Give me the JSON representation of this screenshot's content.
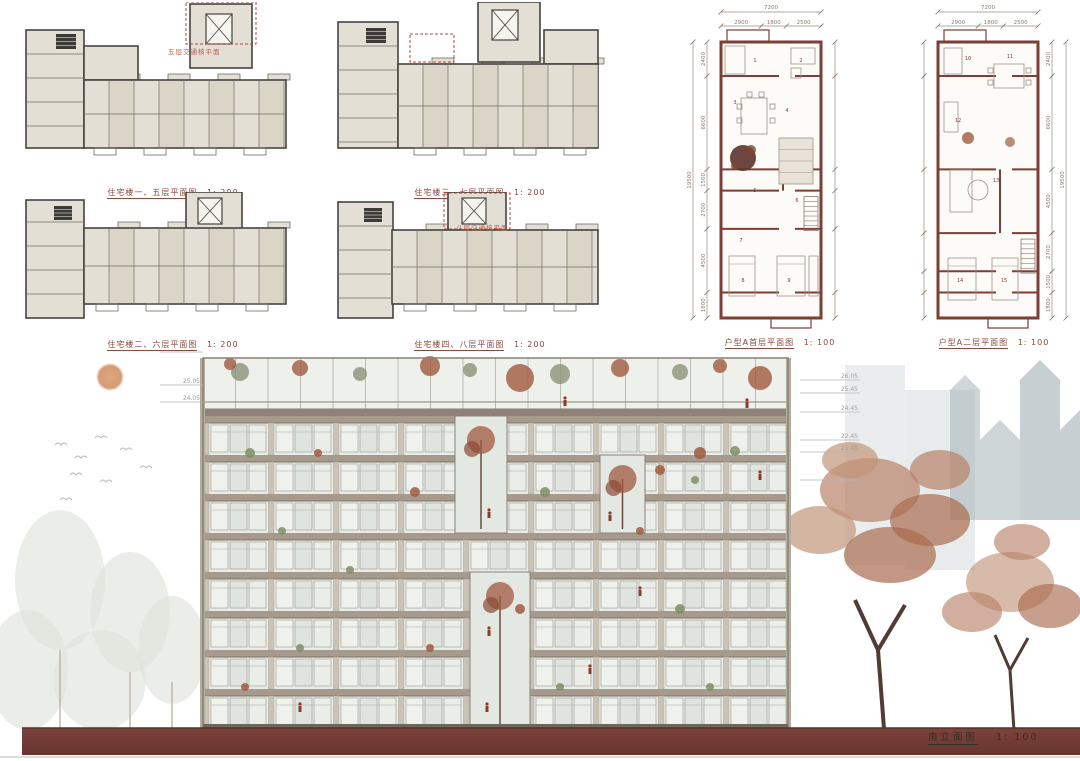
{
  "board": {
    "background": "#ffffff"
  },
  "colors": {
    "accent_red": "#b14a3c",
    "wall_maroon": "#7c3e35",
    "plan_fill": "#e3dfd4",
    "plan_fill_alt": "#d6d0c2",
    "slab": "#a59a8b",
    "ground": "#76403a",
    "sun": "#d1926c",
    "dim_text": "#8a7a6e",
    "level_text": "#9aa39f"
  },
  "floor_plans": [
    {
      "id": "plan1",
      "caption": "住宅楼一、五层平面图",
      "scale": "1: 200",
      "note": "五层交通核平面"
    },
    {
      "id": "plan2",
      "caption": "住宅楼三、七层平面图",
      "scale": "1: 200",
      "note": ""
    },
    {
      "id": "plan3",
      "caption": "住宅楼二、六层平面图",
      "scale": "1: 200",
      "note": ""
    },
    {
      "id": "plan4",
      "caption": "住宅楼四、八层平面图",
      "scale": "1: 200",
      "note": "八层交通核平面"
    }
  ],
  "unit_plans": [
    {
      "id": "unitA1",
      "caption": "户型A首层平面图",
      "scale": "1: 100",
      "dims": {
        "overall_top": "7200",
        "top_segments": [
          "2900",
          "1800",
          "2500"
        ],
        "overall_side": "19500",
        "side_segments": [
          "2400",
          "6600",
          "1500",
          "2700",
          "4500",
          "1800"
        ]
      },
      "room_numbers": [
        "1",
        "2",
        "3",
        "4",
        "5",
        "6",
        "7",
        "8",
        "9"
      ]
    },
    {
      "id": "unitA2",
      "caption": "户型A二层平面图",
      "scale": "1: 100",
      "dims": {
        "overall_top": "7200",
        "top_segments": [
          "2900",
          "1800",
          "2500"
        ],
        "overall_side": "19500",
        "side_segments": [
          "2400",
          "6600",
          "4500",
          "2700",
          "1500",
          "1800"
        ]
      },
      "room_numbers": [
        "10",
        "11",
        "12",
        "13",
        "14",
        "15"
      ]
    }
  ],
  "elevation": {
    "caption": "南立面图",
    "scale": "1: 100",
    "levels_left": [
      "26.50",
      "25.05",
      "24.05"
    ],
    "levels_right": [
      "26.05",
      "25.45",
      "24.45",
      "22.45",
      "21.45",
      "19.45"
    ]
  }
}
